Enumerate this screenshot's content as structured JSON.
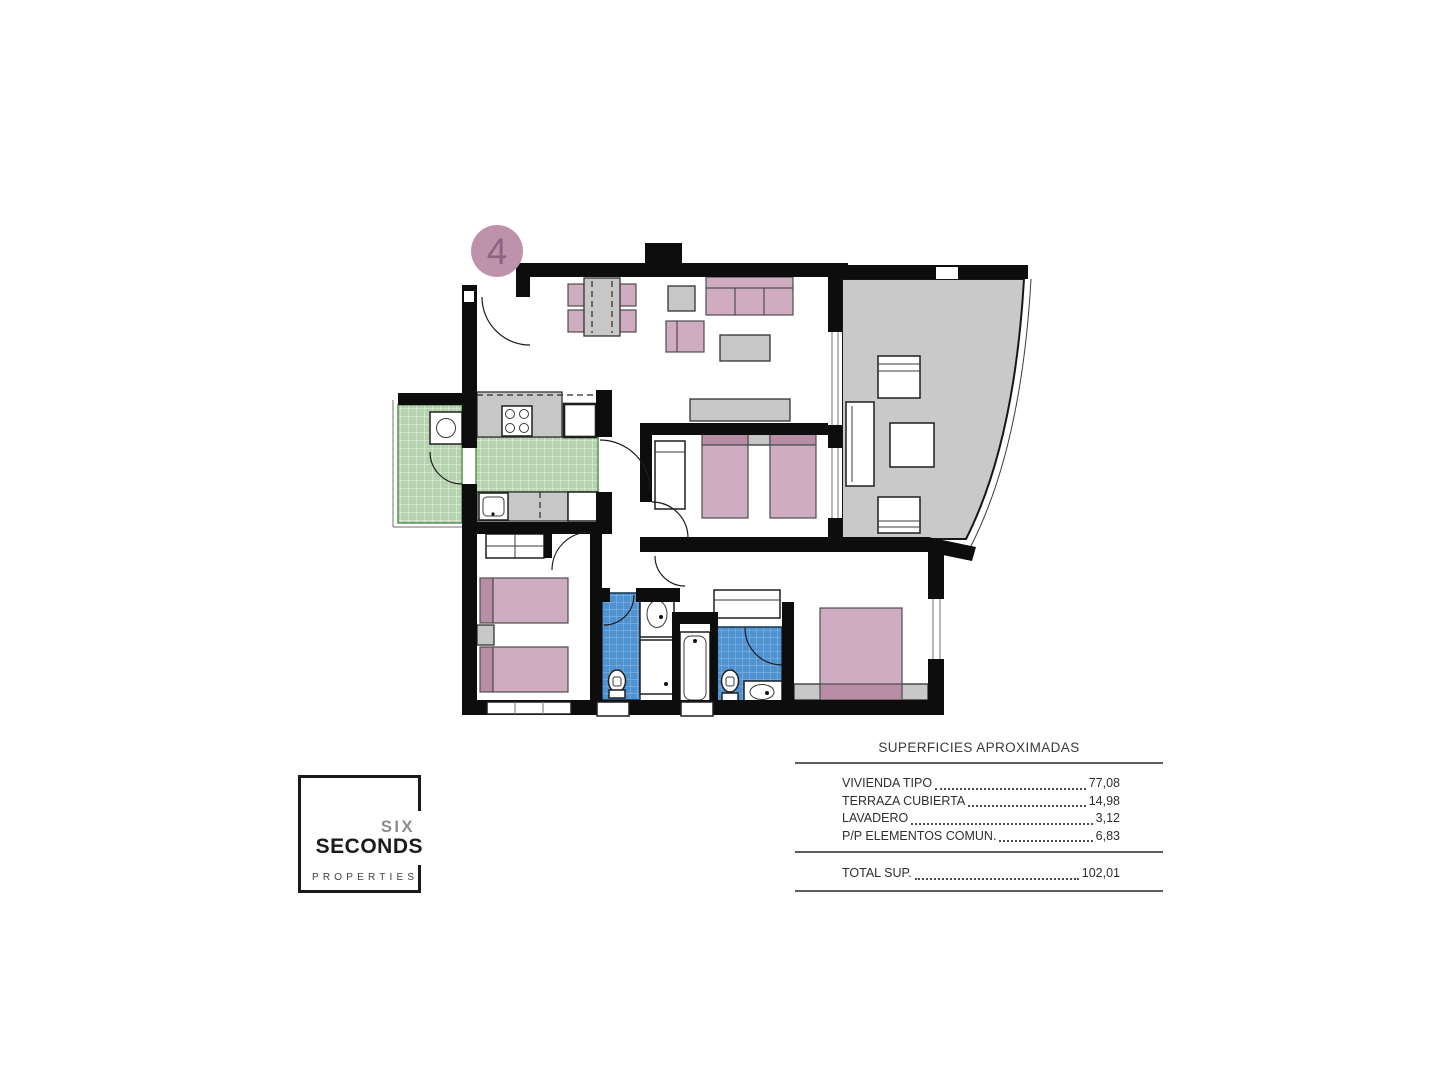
{
  "unit_badge": {
    "number": "4"
  },
  "logo": {
    "six": "SIX",
    "seconds": "SECONDS",
    "properties": "PROPERTIES"
  },
  "areas_table": {
    "title": "SUPERFICIES APROXIMADAS",
    "rows": [
      {
        "label": "VIVIENDA TIPO",
        "value": "77,08"
      },
      {
        "label": "TERRAZA CUBIERTA",
        "value": "14,98"
      },
      {
        "label": "LAVADERO",
        "value": "3,12"
      },
      {
        "label": "P/P ELEMENTOS COMUN.",
        "value": "6,83"
      }
    ],
    "total": {
      "label": "TOTAL SUP.",
      "value": "102,01"
    }
  },
  "floorplan": {
    "colors": {
      "wall": "#0d0d0d",
      "furniture_pink": "#cfacbf",
      "furniture_pink_dark": "#b88da6",
      "furniture_gray": "#c7c7c7",
      "terrace_floor": "#c9c9c9",
      "kitchen_tile_green": "#b5d3ae",
      "bathroom_tile_blue": "#4f92d2",
      "badge_pink": "#bf92ac"
    },
    "rooms": [
      "living-dining",
      "kitchen",
      "laundry",
      "covered-terrace",
      "bedroom-1",
      "bedroom-2",
      "master-bedroom",
      "bathroom-1",
      "bathroom-2",
      "hall"
    ]
  }
}
